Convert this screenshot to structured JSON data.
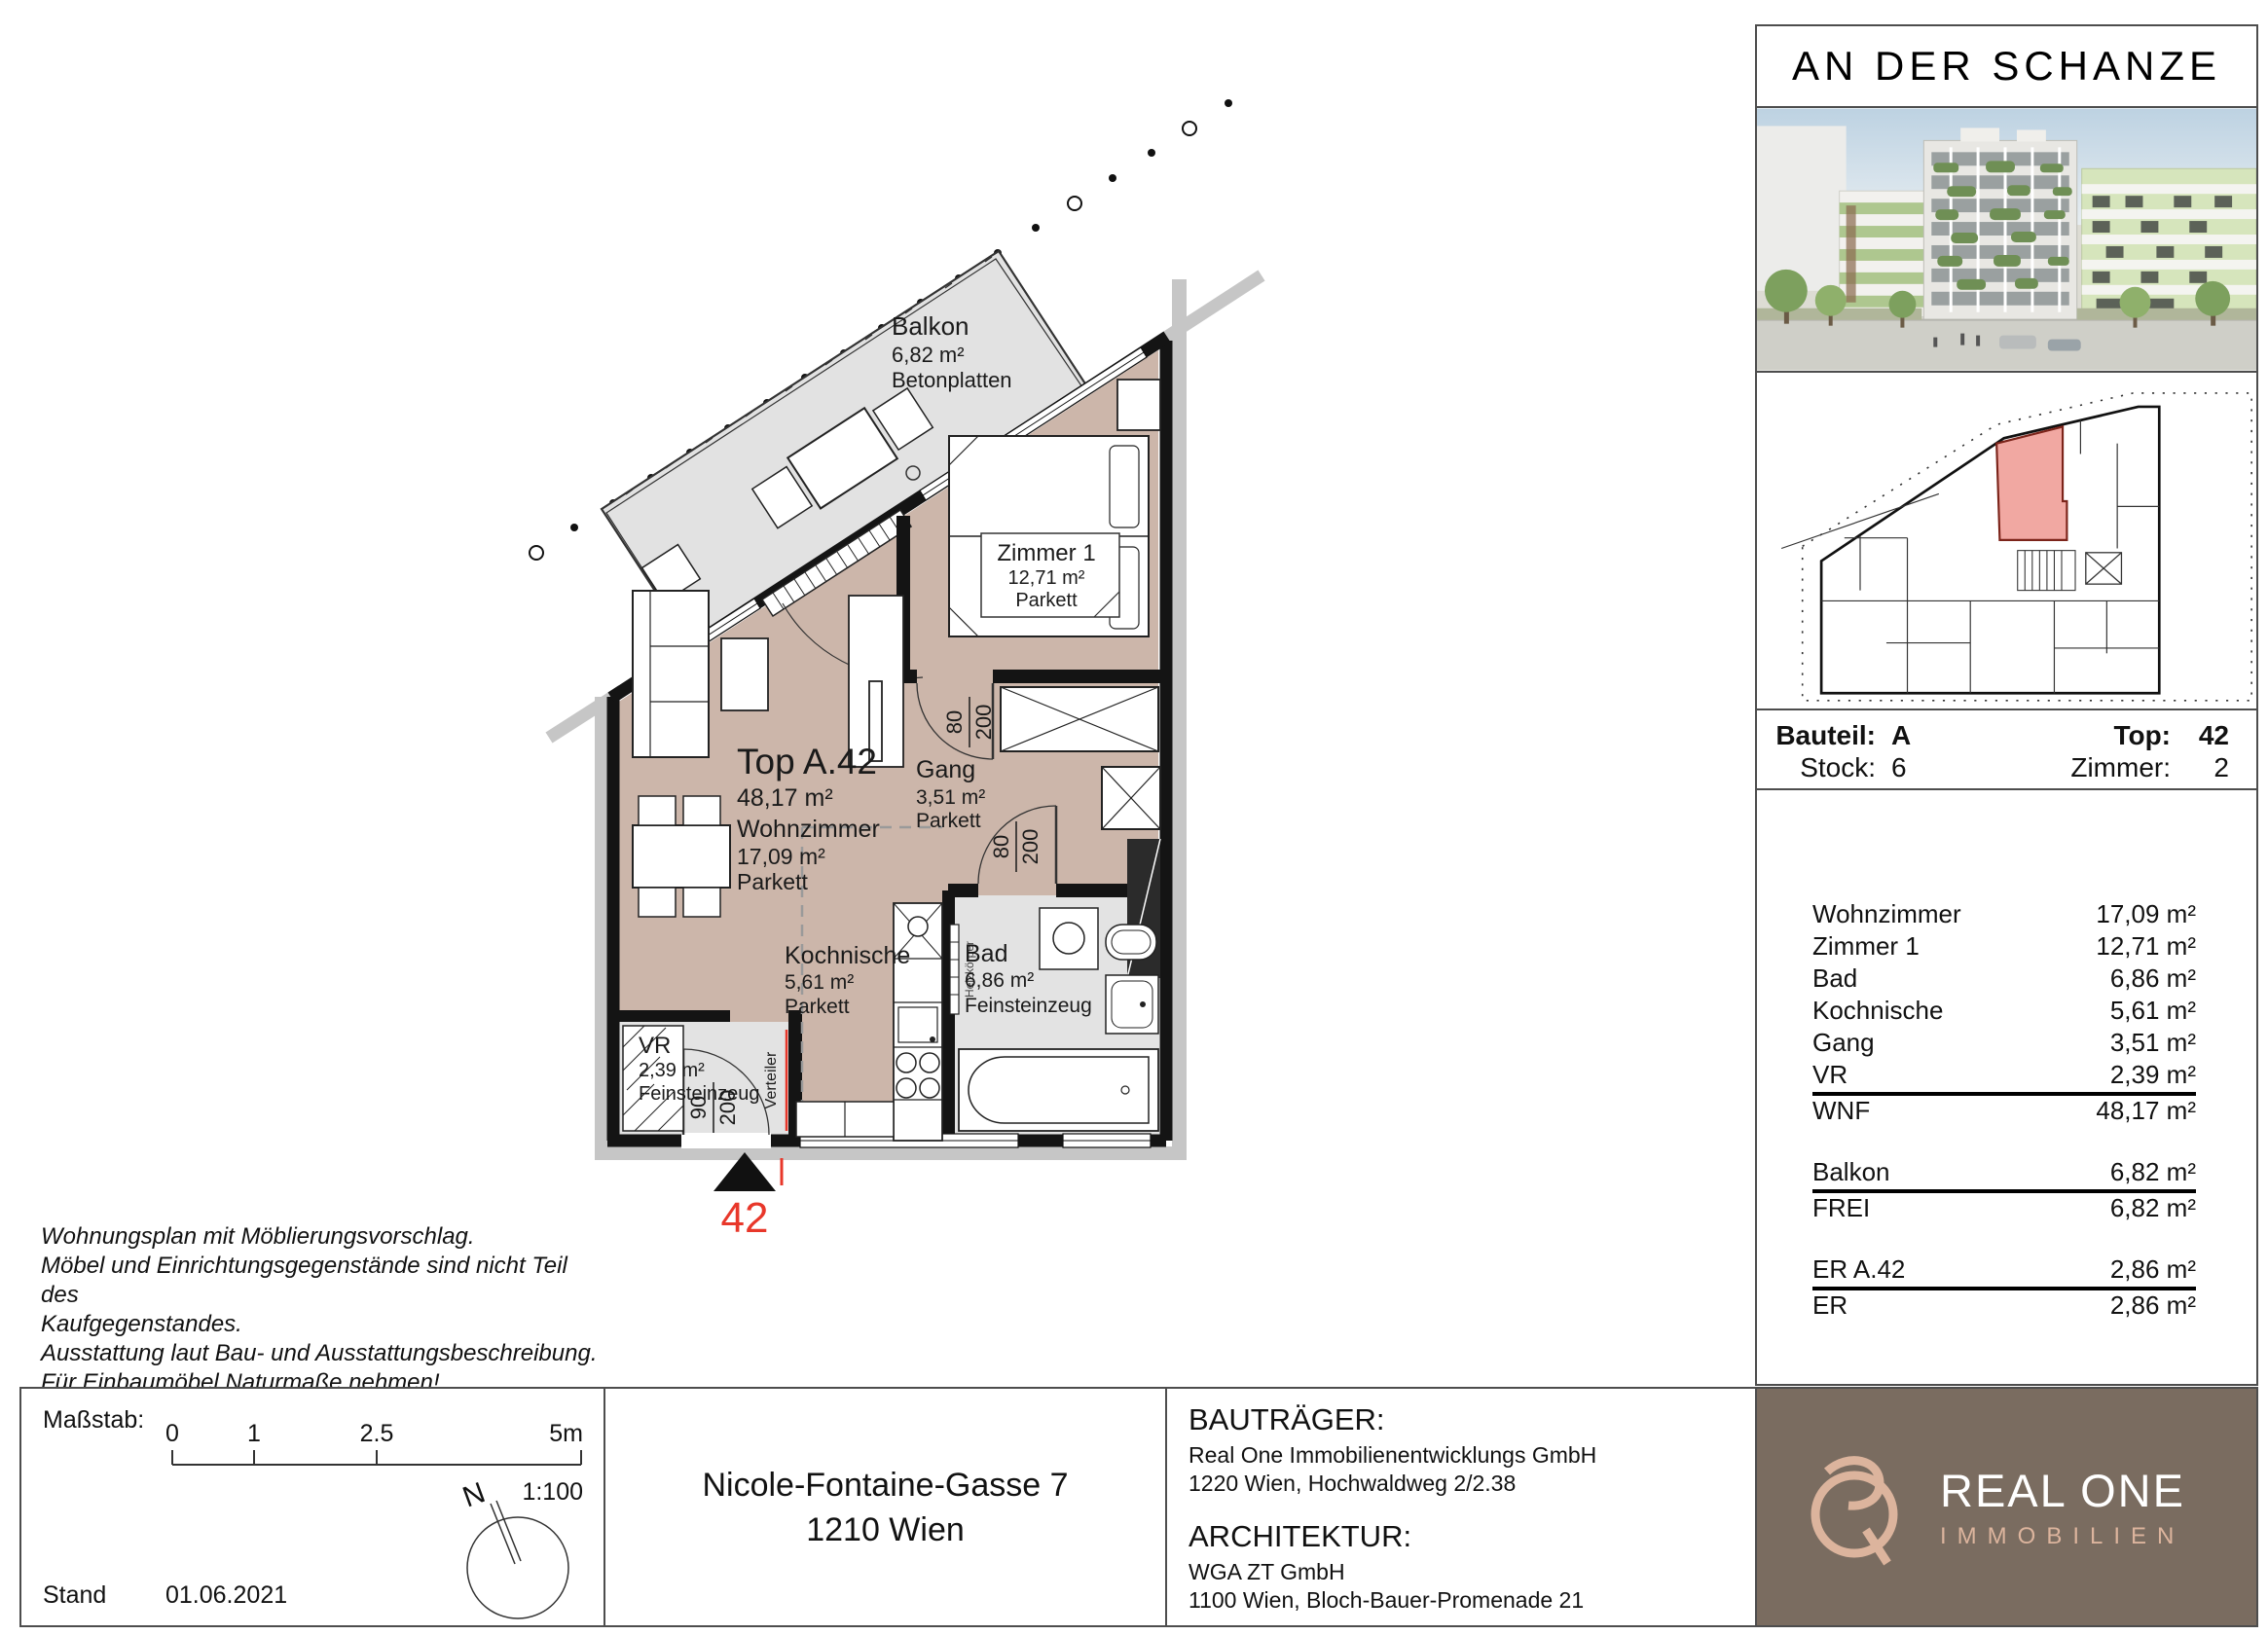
{
  "sidebar": {
    "title": "AN DER SCHANZE",
    "info": {
      "bauteil_label": "Bauteil:",
      "bauteil_value": "A",
      "stock_label": "Stock:",
      "stock_value": "6",
      "top_label": "Top:",
      "top_value": "42",
      "zimmer_label": "Zimmer:",
      "zimmer_value": "2"
    },
    "areas": {
      "rows": [
        {
          "label": "Wohnzimmer",
          "value": "17,09 m²"
        },
        {
          "label": "Zimmer 1",
          "value": "12,71 m²"
        },
        {
          "label": "Bad",
          "value": "6,86 m²"
        },
        {
          "label": "Kochnische",
          "value": "5,61 m²"
        },
        {
          "label": "Gang",
          "value": "3,51 m²"
        },
        {
          "label": "VR",
          "value": "2,39 m²"
        }
      ],
      "wnf": {
        "label": "WNF",
        "value": "48,17 m²"
      },
      "balkon": {
        "label": "Balkon",
        "value": "6,82 m²"
      },
      "frei": {
        "label": "FREI",
        "value": "6,82 m²"
      },
      "er_a42": {
        "label": "ER A.42",
        "value": "2,86 m²"
      },
      "er": {
        "label": "ER",
        "value": "2,86 m²"
      }
    }
  },
  "plan": {
    "unit_number": "42",
    "unit_title": "Top A.42",
    "unit_area": "48,17 m²",
    "rooms": {
      "balkon": {
        "name": "Balkon",
        "area": "6,82 m²",
        "floor": "Betonplatten"
      },
      "zimmer1": {
        "name": "Zimmer 1",
        "area": "12,71 m²",
        "floor": "Parkett"
      },
      "wohnzimmer": {
        "name": "Wohnzimmer",
        "area": "17,09 m²",
        "floor": "Parkett"
      },
      "gang": {
        "name": "Gang",
        "area": "3,51 m²",
        "floor": "Parkett"
      },
      "kochnische": {
        "name": "Kochnische",
        "area": "5,61 m²",
        "floor": "Parkett"
      },
      "bad": {
        "name": "Bad",
        "area": "6,86 m²",
        "floor": "Feinsteinzeug"
      },
      "vr": {
        "name": "VR",
        "area": "2,39 m²",
        "floor": "Feinsteinzeug"
      }
    },
    "annotations": {
      "verteiler": "Verteiler",
      "heizkoerper": "Heizkörper",
      "door_zimmer1_w": "80",
      "door_zimmer1_h": "200",
      "door_bad_w": "80",
      "door_bad_h": "200",
      "door_entry_w": "90",
      "door_entry_h": "200"
    }
  },
  "disclaimer": {
    "line1": "Wohnungsplan mit Möblierungsvorschlag.",
    "line2": "Möbel und Einrichtungsgegenstände sind nicht Teil des",
    "line3": "Kaufgegenstandes.",
    "line4": "Ausstattung laut Bau- und Ausstattungsbeschreibung.",
    "line5": "Für Einbaumöbel Naturmaße nehmen!",
    "line6": "Änderungen vorbehalten!"
  },
  "scalebox": {
    "masstab_label": "Maßstab:",
    "tick0": "0",
    "tick1": "1",
    "tick2": "2.5",
    "tick3": "5m",
    "ratio": "1:100",
    "stand_label": "Stand",
    "stand_date": "01.06.2021",
    "north_label": "N"
  },
  "address": {
    "line1": "Nicole-Fontaine-Gasse 7",
    "line2": "1210 Wien"
  },
  "parties": {
    "bautraeger_heading": "BAUTRÄGER:",
    "bautraeger_name": "Real One Immobilienentwicklungs GmbH",
    "bautraeger_address": "1220 Wien, Hochwaldweg 2/2.38",
    "architektur_heading": "ARCHITEKTUR:",
    "architekt_name": "WGA ZT GmbH",
    "architekt_address": "1100 Wien, Bloch-Bauer-Promenade 21"
  },
  "logo": {
    "brand": "REAL ONE",
    "subtitle": "IMMOBILIEN"
  },
  "colors": {
    "floor_parkett": "#ccb6aa",
    "floor_tile": "#e3e3e3",
    "wall": "#141414",
    "accent_red": "#e8372a",
    "keyplan_highlight": "#f1a8a2",
    "logo_background": "#7a6c60",
    "logo_tan": "#dcb49d"
  }
}
